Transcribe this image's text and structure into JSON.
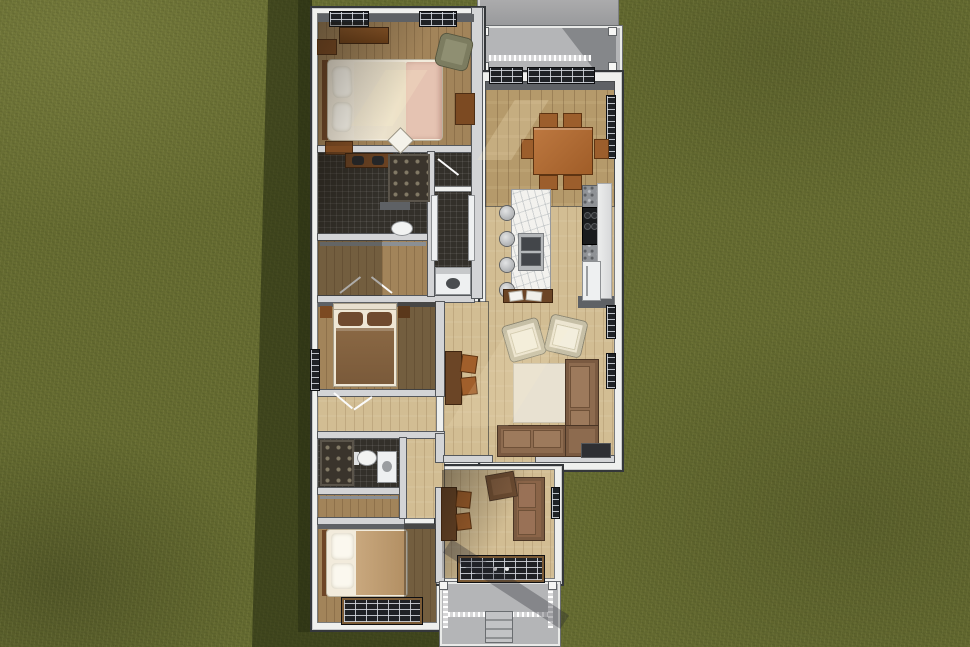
{
  "scene": {
    "type": "3d-floor-plan-rendering",
    "view": "top-down-overhead",
    "description": "Overhead 3D render of a single-story house floor plan set on a grass lot with concrete driveway at top right, covered front porch, and rear porch with steps at bottom",
    "lot": "grass",
    "shadow_side": "left-and-bottom"
  },
  "palette": {
    "grass": "#666c31",
    "grass_shadow": "#4c5323",
    "concrete": "#a8a9aa",
    "porch_floor": "#b4b5b7",
    "eave_white": "#eff0ee",
    "wall_gray": "#d3d4d6",
    "wall_outline": "#34373a",
    "wood_light": "#d2bd93",
    "wood_mid": "#b59a6b",
    "wood_bedroom": "#a2845a",
    "dark_tile": "#33302a",
    "marble_white": "#f3f2ee",
    "granite_gray": "#8f9296",
    "appliance_white": "#eef0f1",
    "stove_black": "#1a1c1e",
    "window_glass": "#1f2226",
    "furniture_brown": "#7c4a22",
    "table_orange": "#ad6a35",
    "sofa_brown": "#8d6b4f",
    "armchair_cream": "#ece5d1",
    "rug_cream": "#e8e1d1",
    "bed_white": "#f2ebdc",
    "bed_blush": "#e5c3b2",
    "bed_tan": "#c9a87e",
    "blanket_brown": "#8a6844",
    "chair_sage": "#8f8f72"
  },
  "site": {
    "driveway": {
      "name": "concrete driveway",
      "position": "top-right"
    },
    "front_porch": {
      "name": "covered front porch",
      "features": [
        "white railing",
        "corner posts",
        "roof shade"
      ]
    },
    "rear_porch": {
      "name": "rear covered porch",
      "features": [
        "white railing",
        "entry steps",
        "corner posts"
      ]
    }
  },
  "house": {
    "rooms": [
      {
        "id": "master-bedroom",
        "name": "Master Bedroom",
        "floor": "wood",
        "furniture": [
          "queen bed with white linens and blush throw",
          "two nightstands",
          "dresser",
          "sage accent chair",
          "wardrobe cabinet",
          "two top-wall windows",
          "floor mat"
        ]
      },
      {
        "id": "master-bathroom",
        "name": "Master Bathroom",
        "floor": "dark tile",
        "furniture": [
          "double-sink vanity",
          "patterned walk-in shower",
          "toilet",
          "half wall"
        ]
      },
      {
        "id": "master-closet",
        "name": "Walk-in Closet",
        "floor": "wood",
        "furniture": [
          "shelving"
        ]
      },
      {
        "id": "wc-shower",
        "name": "Shower Room",
        "floor": "dark tile",
        "furniture": [
          "door"
        ]
      },
      {
        "id": "laundry",
        "name": "Laundry Room",
        "floor": "dark tile",
        "furniture": [
          "washer",
          "side counters"
        ]
      },
      {
        "id": "bedroom-2",
        "name": "Bedroom 2",
        "floor": "wood",
        "furniture": [
          "bed with brown blanket",
          "two nightstands",
          "left-wall window"
        ]
      },
      {
        "id": "hallway-1",
        "name": "Hallway",
        "floor": "wood",
        "furniture": [
          "door swings"
        ]
      },
      {
        "id": "bathroom-2",
        "name": "Bathroom 2",
        "floor": "dark tile",
        "furniture": [
          "shower",
          "toilet",
          "vanity"
        ]
      },
      {
        "id": "closet-2",
        "name": "Closet",
        "floor": "wood",
        "furniture": [
          "shelf"
        ]
      },
      {
        "id": "bedroom-3",
        "name": "Bedroom 3",
        "floor": "wood",
        "furniture": [
          "bed with tan blanket and white pillows",
          "bottom-wall window"
        ]
      },
      {
        "id": "dining-room",
        "name": "Dining Room",
        "floor": "wood",
        "furniture": [
          "rectangular table",
          "six chairs",
          "top-wall windows",
          "right-wall window"
        ]
      },
      {
        "id": "kitchen",
        "name": "Kitchen",
        "floor": "wood",
        "furniture": [
          "marble island with double sink",
          "four barstools",
          "granite counter",
          "range with four burners",
          "refrigerator",
          "tall cabinets"
        ]
      },
      {
        "id": "living-room",
        "name": "Living Room",
        "floor": "wood",
        "furniture": [
          "two cream armchairs",
          "L-shaped brown sectional sofa",
          "area rug",
          "console table with books",
          "wall desk with two chairs",
          "doormat",
          "right-wall windows"
        ]
      },
      {
        "id": "den",
        "name": "Den / Rear Entry",
        "floor": "wood",
        "furniture": [
          "loveseat",
          "armchair",
          "wall desk with two chairs",
          "glazed rear door"
        ]
      }
    ]
  }
}
